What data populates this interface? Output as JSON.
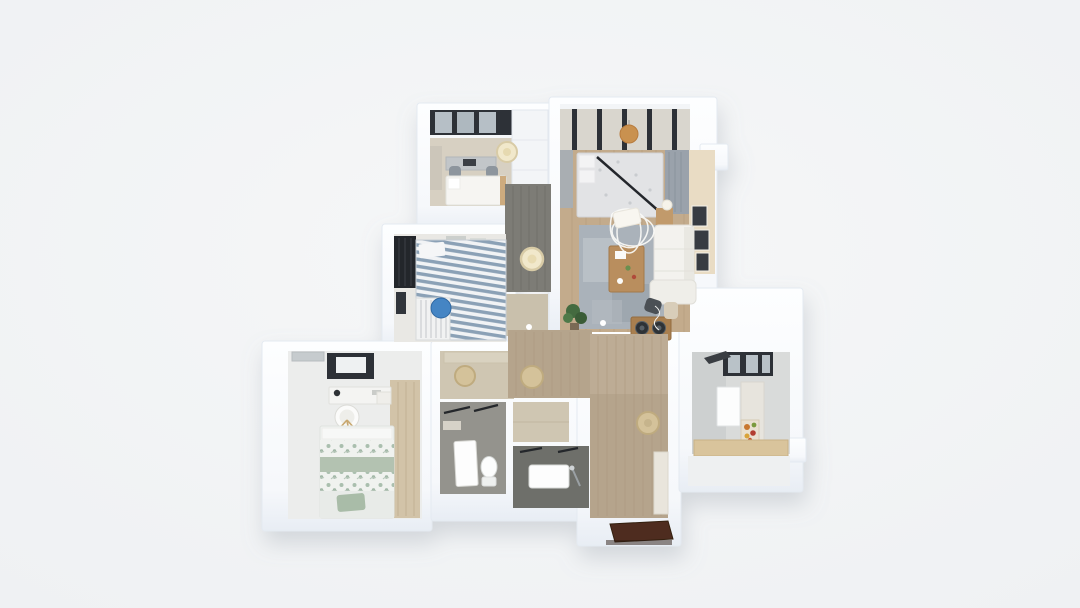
{
  "scene": {
    "description": "3D top-down isometric render of an apartment floor plan on a plain light-gray background. No text labels are visible.",
    "background_color": "#f3f5f6"
  },
  "palette": {
    "wall_top": "#fdfeff",
    "wall_shade": "#e8edf4",
    "beige_floor": "#d7d0c2",
    "corridor_floor": "#7d7c76",
    "wood_floor": "#c3ab8c",
    "entry_wood": "#b5a48c",
    "hall_beige": "#cfc6b2",
    "bath_gray": "#94938d",
    "bath_dark": "#6e6f6a",
    "kitchen_floor": "#d9dbda",
    "kids_floor": "#e9e8e4",
    "master_floor": "#ecedec",
    "rug_gray": "#aab2ba",
    "table_wood": "#b98e5e",
    "sofa_white": "#f3f2ee",
    "accent_cream_wall": "#e9dcc4",
    "bed_sage": "#b3c2b1",
    "stripe_blue": "#8ba1b6",
    "accent_blue_stool": "#4585c4",
    "pendant_cream": "#f1e8cb",
    "pendant_orange": "#c9914f",
    "stool_tan": "#d4c29a",
    "window_dark": "#2d3137",
    "wardrobe_dark": "#23262b",
    "door_brown": "#4e2c1f",
    "plant_green": "#3f663c",
    "counter_tan": "#d9c49c"
  },
  "rooms": [
    {
      "name": "study"
    },
    {
      "name": "living-room"
    },
    {
      "name": "corridor"
    },
    {
      "name": "kids-bedroom"
    },
    {
      "name": "master-bedroom"
    },
    {
      "name": "inner-hall"
    },
    {
      "name": "bathroom-1"
    },
    {
      "name": "storage-closet"
    },
    {
      "name": "bathroom-2"
    },
    {
      "name": "entry-hall"
    },
    {
      "name": "kitchen"
    }
  ],
  "fixtures": {
    "cream_ceiling_lights": 2,
    "tan_ceiling_lights": 3,
    "orange_pendant_lights": 1,
    "blue_stools": 1,
    "entry_doors": 1
  }
}
